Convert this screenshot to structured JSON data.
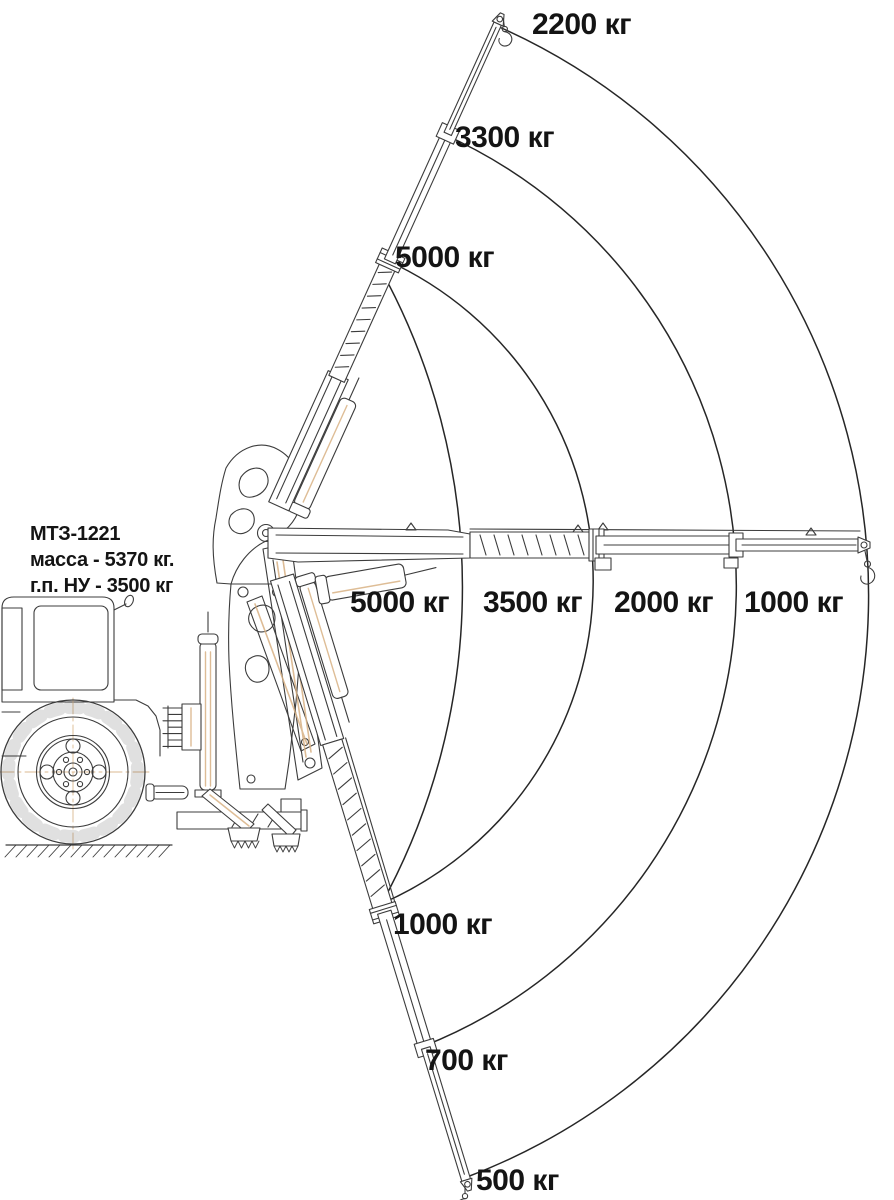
{
  "machine_info": {
    "model": "МТЗ-1221",
    "mass": "масса - 5370 кг.",
    "capacity": "г.п. НУ - 3500 кг"
  },
  "capacities": {
    "boom_raised": [
      "2200 кг",
      "3300 кг",
      "5000 кг"
    ],
    "boom_horizontal": [
      "5000 кг",
      "3500 кг",
      "2000 кг",
      "1000 кг"
    ],
    "boom_lowered": [
      "1000 кг",
      "700 кг",
      "500 кг"
    ]
  },
  "load_chart": {
    "type": "load-capacity-diagram",
    "unit": "кг",
    "boom_positions": [
      {
        "position": "raised",
        "capacities_kg": [
          2200,
          3300,
          5000
        ]
      },
      {
        "position": "horizontal",
        "capacities_kg": [
          5000,
          3500,
          2000,
          1000
        ]
      },
      {
        "position": "lowered",
        "capacities_kg": [
          1000,
          700,
          500
        ]
      }
    ]
  },
  "colors": {
    "background": "#ffffff",
    "machine_line": "#3c3c3c",
    "arc_line": "#262626",
    "text": "#141414",
    "accent": "#d8b184"
  }
}
